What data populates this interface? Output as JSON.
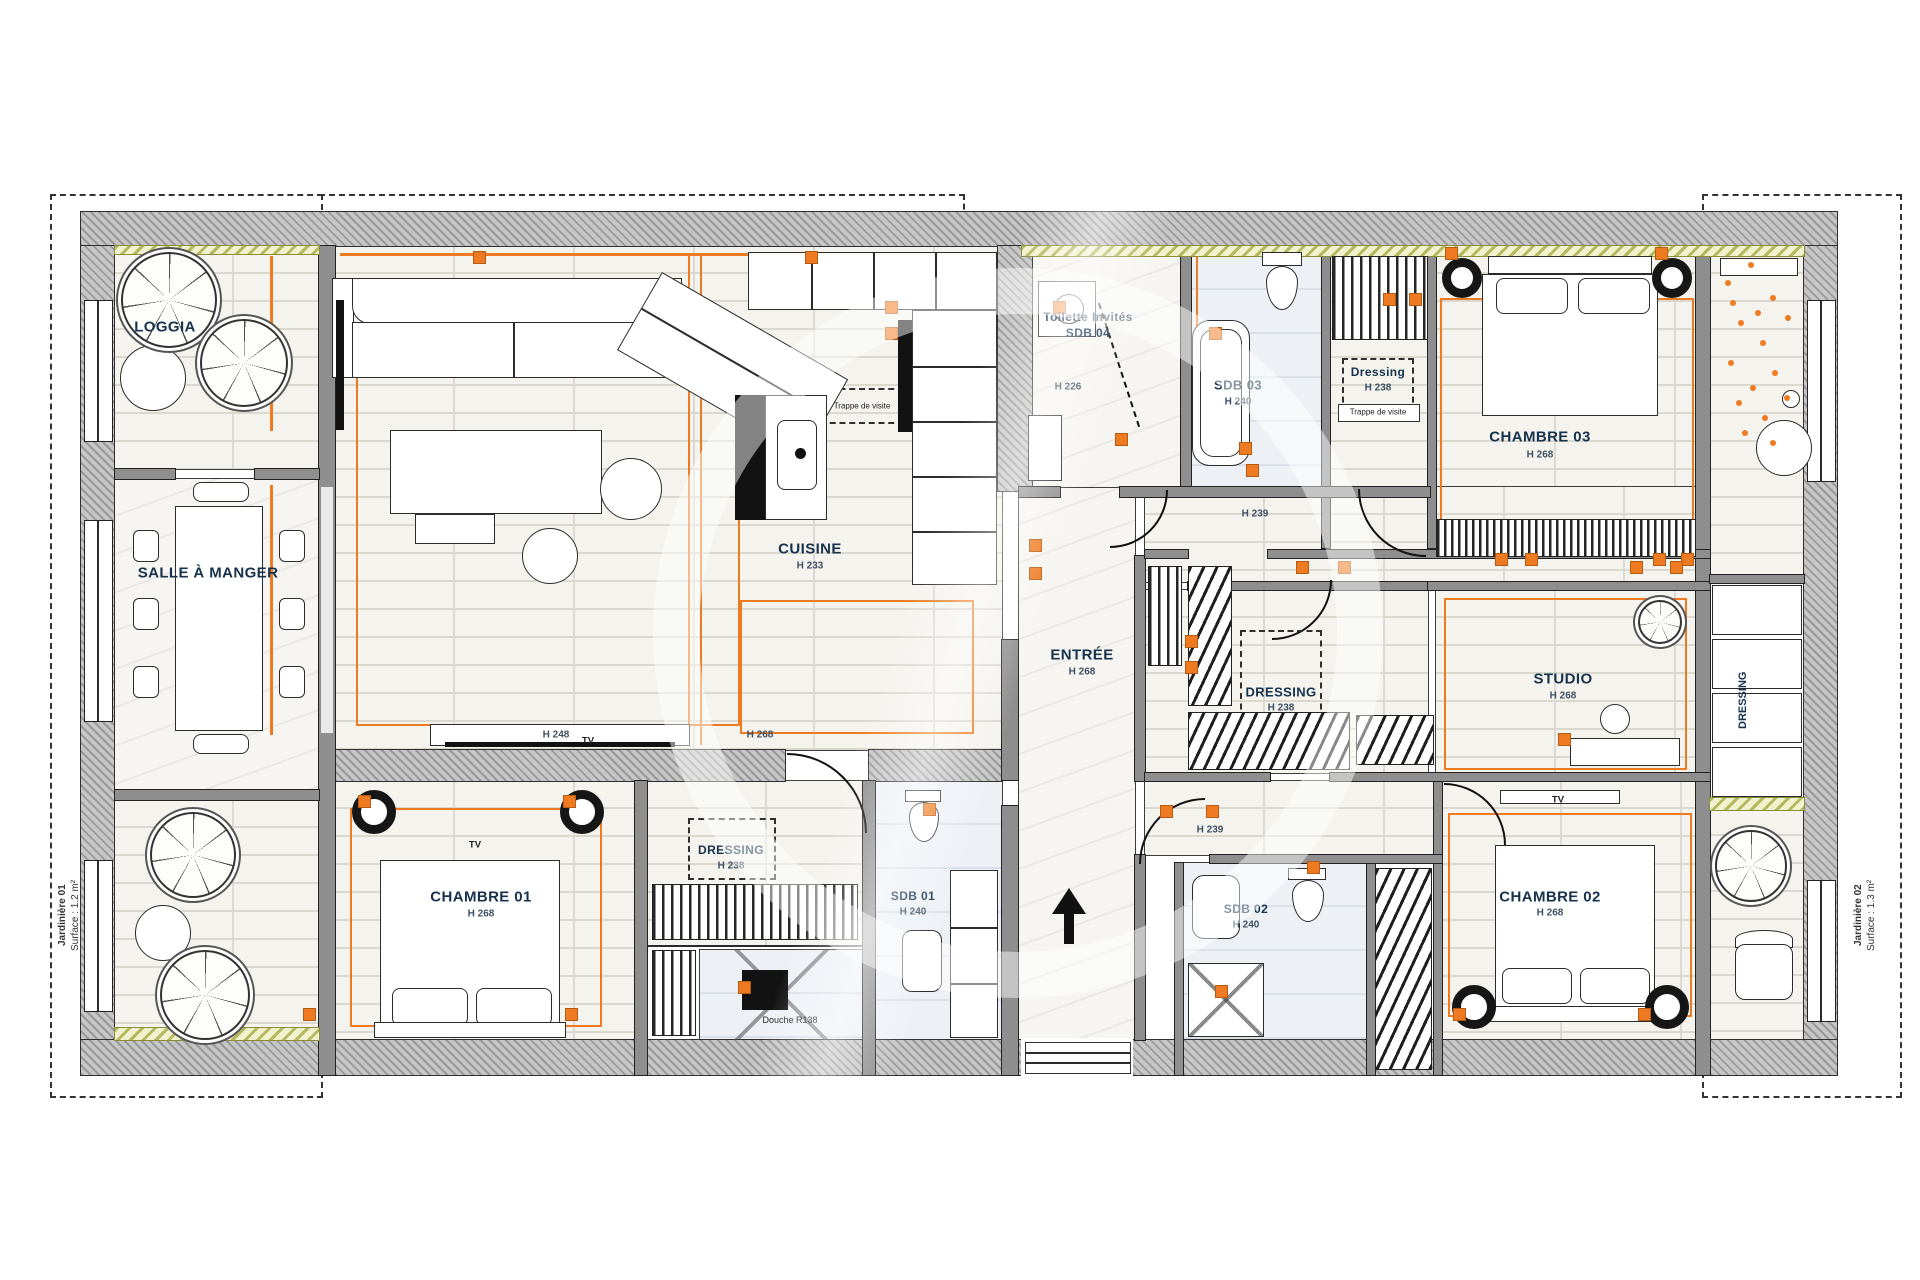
{
  "colors": {
    "accent": "#ee7b22",
    "wall_gray": "#c6c6c6",
    "insulation_yellow": "#f0f1cd",
    "bath_floor_blue": "#edf1f6",
    "floor_beige": "#f4f3ee",
    "label_navy": "#16324c"
  },
  "labels": {
    "loggia": "LOGGIA",
    "salle": "SALLE À MANGER",
    "cuisine": "CUISINE",
    "cuisine_h": "H 233",
    "toilette1": "Toilette Invités",
    "toilette2": "SDB 04",
    "toilette_h": "H 226",
    "sdb03": "SDB 03",
    "sdb03_h": "H 240",
    "dressing03": "Dressing",
    "dressing03_h": "H 238",
    "trappe": "Trappe de visite",
    "trappe2": "Trappe de visite",
    "chambre03": "CHAMBRE 03",
    "chambre03_h": "H 268",
    "entree": "ENTRÉE",
    "entree_h": "H 268",
    "dressing_c": "DRESSING",
    "dressing_c_h": "H 238",
    "studio": "STUDIO",
    "studio_h": "H 268",
    "chambre01": "CHAMBRE 01",
    "chambre01_h": "H 268",
    "dressing01": "DRESSING",
    "dressing01_h": "H 238",
    "douche": "Douche R138",
    "sdb01": "SDB 01",
    "sdb01_h": "H 240",
    "sdb02": "SDB 02",
    "sdb02_h": "H 240",
    "chambre02": "CHAMBRE 02",
    "chambre02_h": "H 268",
    "jard01": "Jardinière 01",
    "jard01_s": "Surface : 1.2 m²",
    "jard02": "Jardinière 02",
    "jard02_s": "Surface : 1.3 m²",
    "dressing_r": "DRESSING",
    "tv1": "TV",
    "tv2": "TV",
    "tv3": "TV",
    "h248": "H 248",
    "h268a": "H 268",
    "h239a": "H 239",
    "h239b": "H 239"
  }
}
